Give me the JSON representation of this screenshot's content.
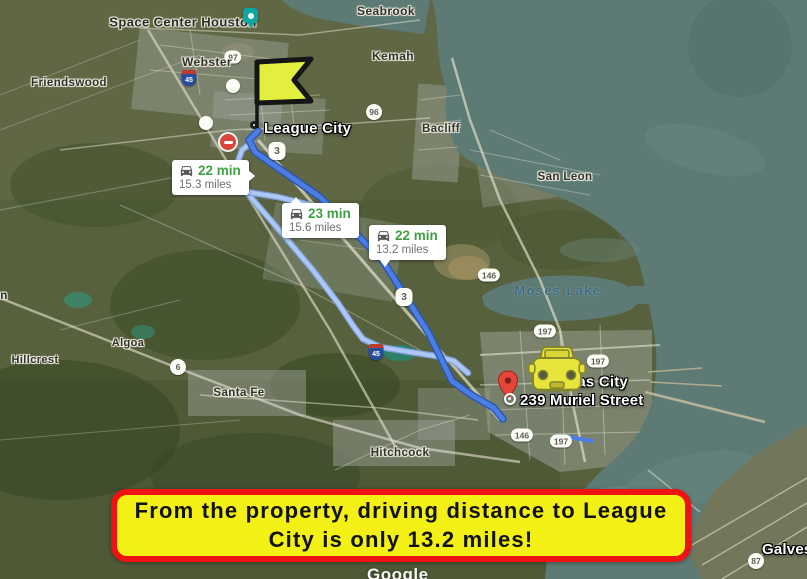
{
  "map": {
    "attribution": "Google",
    "places": {
      "space_center_houston": "Space Center Houston",
      "webster": "Webster",
      "seabrook": "Seabrook",
      "kemah": "Kemah",
      "friendswood": "Friendswood",
      "bacliff": "Bacliff",
      "san_leon": "San Leon",
      "league_city": "League City",
      "moses_lake": "Moses Lake",
      "texas_city": "Texas City",
      "hillcrest": "Hillcrest",
      "algoa": "Algoa",
      "santa_fe": "Santa Fe",
      "hitchcock": "Hitchcock",
      "galveston": "Galveston",
      "edge_partial": "n"
    },
    "shields": {
      "hwy3": "3",
      "hwy6": "6",
      "hwy87": "87",
      "hwy96": "96",
      "hwy97": "97",
      "hwy146": "146",
      "hwy197": "197",
      "i45": "45"
    }
  },
  "markers": {
    "destination_address": "239 Muriel Street"
  },
  "route_bubbles": [
    {
      "duration": "22 min",
      "distance": "15.3 miles"
    },
    {
      "duration": "23 min",
      "distance": "15.6 miles"
    },
    {
      "duration": "22 min",
      "distance": "13.2 miles"
    }
  ],
  "banner": {
    "text": "From the property, driving distance to League City is only 13.2 miles!"
  },
  "colors": {
    "route_main": "#4b7de4",
    "route_main_casing": "#2a55ad",
    "route_alt": "#adc8f4",
    "duration_green": "#3fa044",
    "banner_bg": "#f3f016",
    "banner_border": "#ee1212",
    "flag_fill": "#e3ef3f",
    "car_fill": "#e7e43c",
    "pin_red": "#e8453a",
    "water": "#5d7a74"
  }
}
